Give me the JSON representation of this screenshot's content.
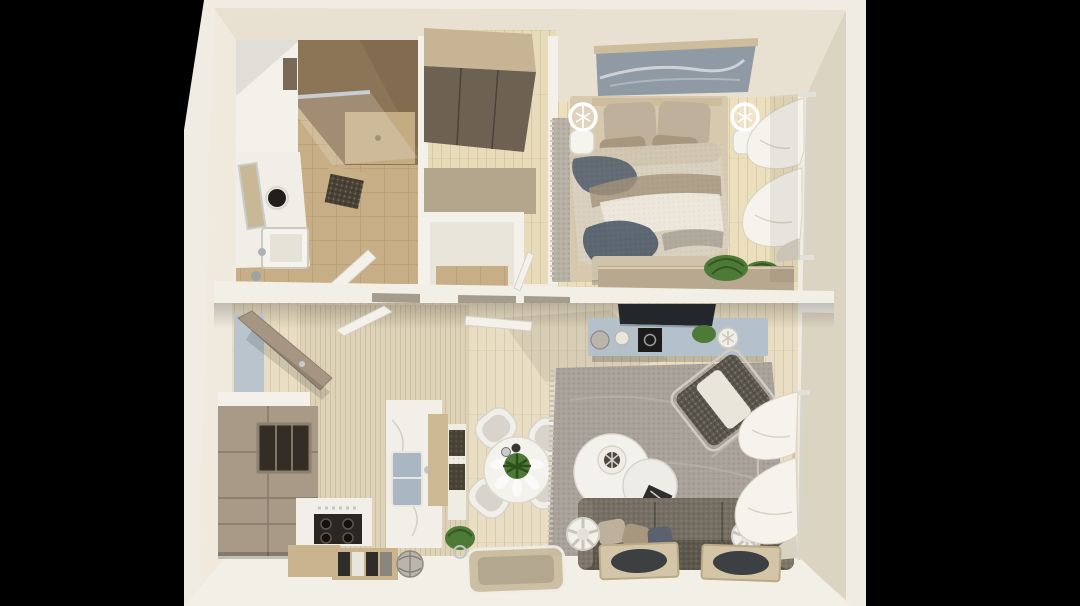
{
  "scene": {
    "subject": "top-down photograph of a miniature one-bedroom apartment architectural scale model",
    "rooms": [
      {
        "name": "bathroom",
        "items": [
          "walk-in-shower",
          "glass-shower-screen",
          "vanity-counter",
          "round-basin",
          "leaning-mirror",
          "square-sink",
          "woven-stool",
          "door"
        ]
      },
      {
        "name": "closet-hall",
        "items": [
          "wardrobe",
          "wc-room",
          "doors"
        ]
      },
      {
        "name": "bedroom",
        "items": [
          "double-bed",
          "patterned-blanket",
          "pillows",
          "headboard",
          "wall-art",
          "two-sphere-lamps",
          "area-rug",
          "foot-bench",
          "dresser",
          "plant",
          "sheer-curtains"
        ]
      },
      {
        "name": "living-kitchen",
        "items": [
          "entry-door",
          "tall-cabinets",
          "oven-niche",
          "cooktop",
          "island-with-sink",
          "baskets",
          "leaning-prints",
          "wire-sphere",
          "round-dining-table",
          "four-chairs",
          "centerpiece-plant",
          "grey-rug",
          "round-coffee-table",
          "lounge-armchair",
          "tv",
          "media-console",
          "three-seat-sofa",
          "sofa-pillows",
          "two-drum-stools",
          "leaning-framed-trays",
          "glass-tray",
          "sheer-curtains",
          "plants"
        ]
      }
    ]
  },
  "palette": {
    "background": "#000000",
    "frame_white": "#f0ece3",
    "reveal_top": "#e8e1d2",
    "reveal_right": "#dcd4c2",
    "reveal_left": "#efeadd",
    "reveal_bottom": "#f2efe7",
    "wall_white": "#f4f1ea",
    "divider_wall": "#f2efe7",
    "bathroom_tile": "#c7ae86",
    "shower_wall": "#8c7456",
    "shower_wall_dark": "#7b654a",
    "vanity_white": "#f1eee7",
    "sink_dark": "#221e1a",
    "mirror_tan": "#c9b896",
    "closet_floor": "#e8dbba",
    "wardrobe_top": "#c6b494",
    "wardrobe_doors": "#6d6152",
    "wc_wall_tan": "#b4a58d",
    "bedroom_floor": "#ecdfbd",
    "art_blue": "#8f9aa4",
    "art_frame": "#cdbd9c",
    "pillow_taupe": "#bfb09c",
    "pillow_dark": "#a8977f",
    "blanket_base": "#d9d0c0",
    "blanket_navy": "#4e5a68",
    "blanket_tan": "#a2937a",
    "blanket_cream": "#eee9de",
    "bed_rug": "#b8b1a6",
    "bench": "#cfc3ac",
    "dresser": "#b7a88f",
    "plant_green": "#4e7a38",
    "plant_dark": "#35571f",
    "curtain": "#f6f3ec",
    "curtain_shade": "#d8d2c4",
    "rod_silver": "#d8d5cd",
    "living_floor": "#e9dec3",
    "kitchen_floor": "#ded3b8",
    "cabinet_taupe": "#a89a86",
    "cabinet_niche": "#332d26",
    "counter_white": "#f2efe8",
    "stove_black": "#2a2622",
    "sink_blue": "#aab7c3",
    "island_wood": "#cdb991",
    "basket_dark": "#4b4236",
    "crate_wood": "#c9b48d",
    "print_dark": "#2f2d2a",
    "sphere_silver": "#b9b5ad",
    "table_white": "#f4f2ed",
    "chair_white": "#f1efe9",
    "chair_shadow": "#d8d4cb",
    "rug_grey": "#a9a29a",
    "rug_light": "#bab4ac",
    "coffee_white": "#f3f1ec",
    "sofa_grey": "#766f63",
    "sofa_dark": "#5d574c",
    "stool_white": "#f2f0ea",
    "console_blue": "#b5c1ca",
    "tv_black": "#23262a",
    "armchair_dark": "#5b564d",
    "armchair_cushion": "#e9e5da",
    "door_taupe": "#a59582",
    "entry_mirror": "#b9c4cd",
    "tray_glass": "#cbbda0",
    "tray_circle": "#3c4043"
  }
}
